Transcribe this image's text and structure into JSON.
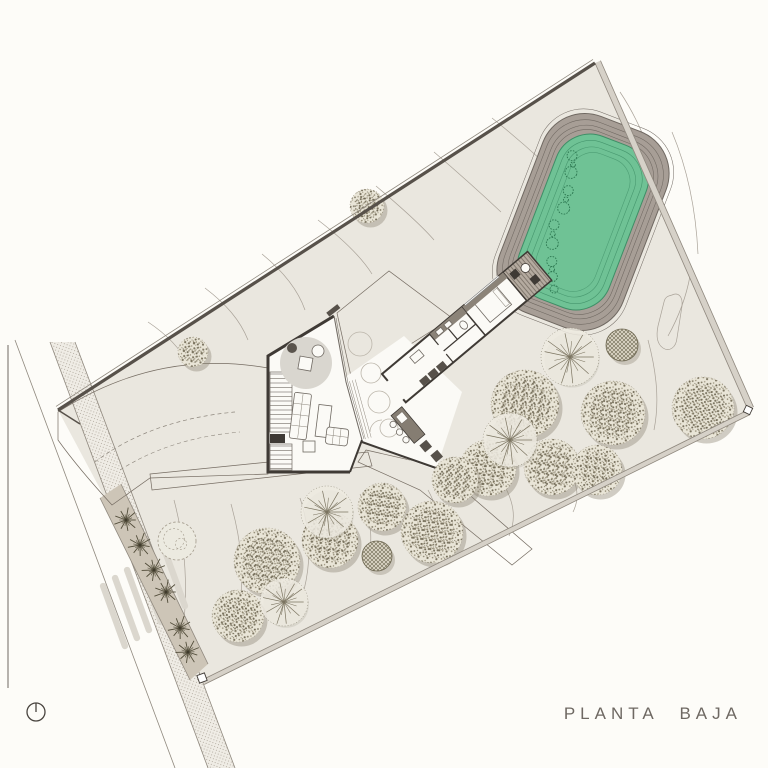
{
  "title": {
    "label": "PLANTA BAJA"
  },
  "colors": {
    "page_bg": "#fdfcf8",
    "site_fill": "#eae7df",
    "line": "#8f887e",
    "wall": "#3f3a35",
    "deck_fill": "#b5aba0",
    "deck_line": "#756c62",
    "planted": "#cdc5b7",
    "pool_green": "#6fc295",
    "pool_ring": "#3e8e66",
    "berm_fill": "#a79e96",
    "berm_line": "#6f6861",
    "contour": "#a9a298",
    "tree_fill": "#e9e5d7",
    "tree_dot": "#7b7460",
    "crosswalk": "#dbd7ce",
    "title_color": "#6e6862"
  },
  "pool": {
    "cx": 583,
    "cy": 222,
    "rot": 21
  },
  "trees": [
    {
      "type": "stipple",
      "x": 367,
      "y": 206,
      "r": 17
    },
    {
      "type": "stipple",
      "x": 193,
      "y": 352,
      "r": 15
    },
    {
      "type": "stipple",
      "x": 525,
      "y": 404,
      "r": 34
    },
    {
      "type": "stipple",
      "x": 613,
      "y": 413,
      "r": 32
    },
    {
      "type": "stipple",
      "x": 703,
      "y": 408,
      "r": 31
    },
    {
      "type": "stipple",
      "x": 488,
      "y": 468,
      "r": 28
    },
    {
      "type": "stipple",
      "x": 455,
      "y": 480,
      "r": 23
    },
    {
      "type": "stipple",
      "x": 552,
      "y": 467,
      "r": 28
    },
    {
      "type": "stipple",
      "x": 597,
      "y": 470,
      "r": 25
    },
    {
      "type": "stipple",
      "x": 267,
      "y": 561,
      "r": 33
    },
    {
      "type": "stipple",
      "x": 238,
      "y": 616,
      "r": 26
    },
    {
      "type": "stipple",
      "x": 330,
      "y": 540,
      "r": 28
    },
    {
      "type": "stipple",
      "x": 382,
      "y": 507,
      "r": 24
    },
    {
      "type": "stipple",
      "x": 432,
      "y": 532,
      "r": 31
    },
    {
      "type": "dense",
      "x": 622,
      "y": 345,
      "r": 16
    },
    {
      "type": "dense",
      "x": 377,
      "y": 556,
      "r": 15
    },
    {
      "type": "sketch",
      "x": 177,
      "y": 541,
      "r": 19
    },
    {
      "type": "palm",
      "x": 570,
      "y": 357,
      "r": 29
    },
    {
      "type": "palm",
      "x": 510,
      "y": 440,
      "r": 27
    },
    {
      "type": "palm",
      "x": 327,
      "y": 512,
      "r": 26
    },
    {
      "type": "palm",
      "x": 284,
      "y": 602,
      "r": 24
    }
  ],
  "street_palms": [
    [
      126,
      520
    ],
    [
      140,
      545
    ],
    [
      154,
      570
    ],
    [
      166,
      592
    ],
    [
      180,
      628
    ],
    [
      188,
      652
    ]
  ],
  "zebra": {
    "count": 6,
    "start_x": 114,
    "start_y": 616,
    "step_x": 12,
    "step_y": -8
  }
}
